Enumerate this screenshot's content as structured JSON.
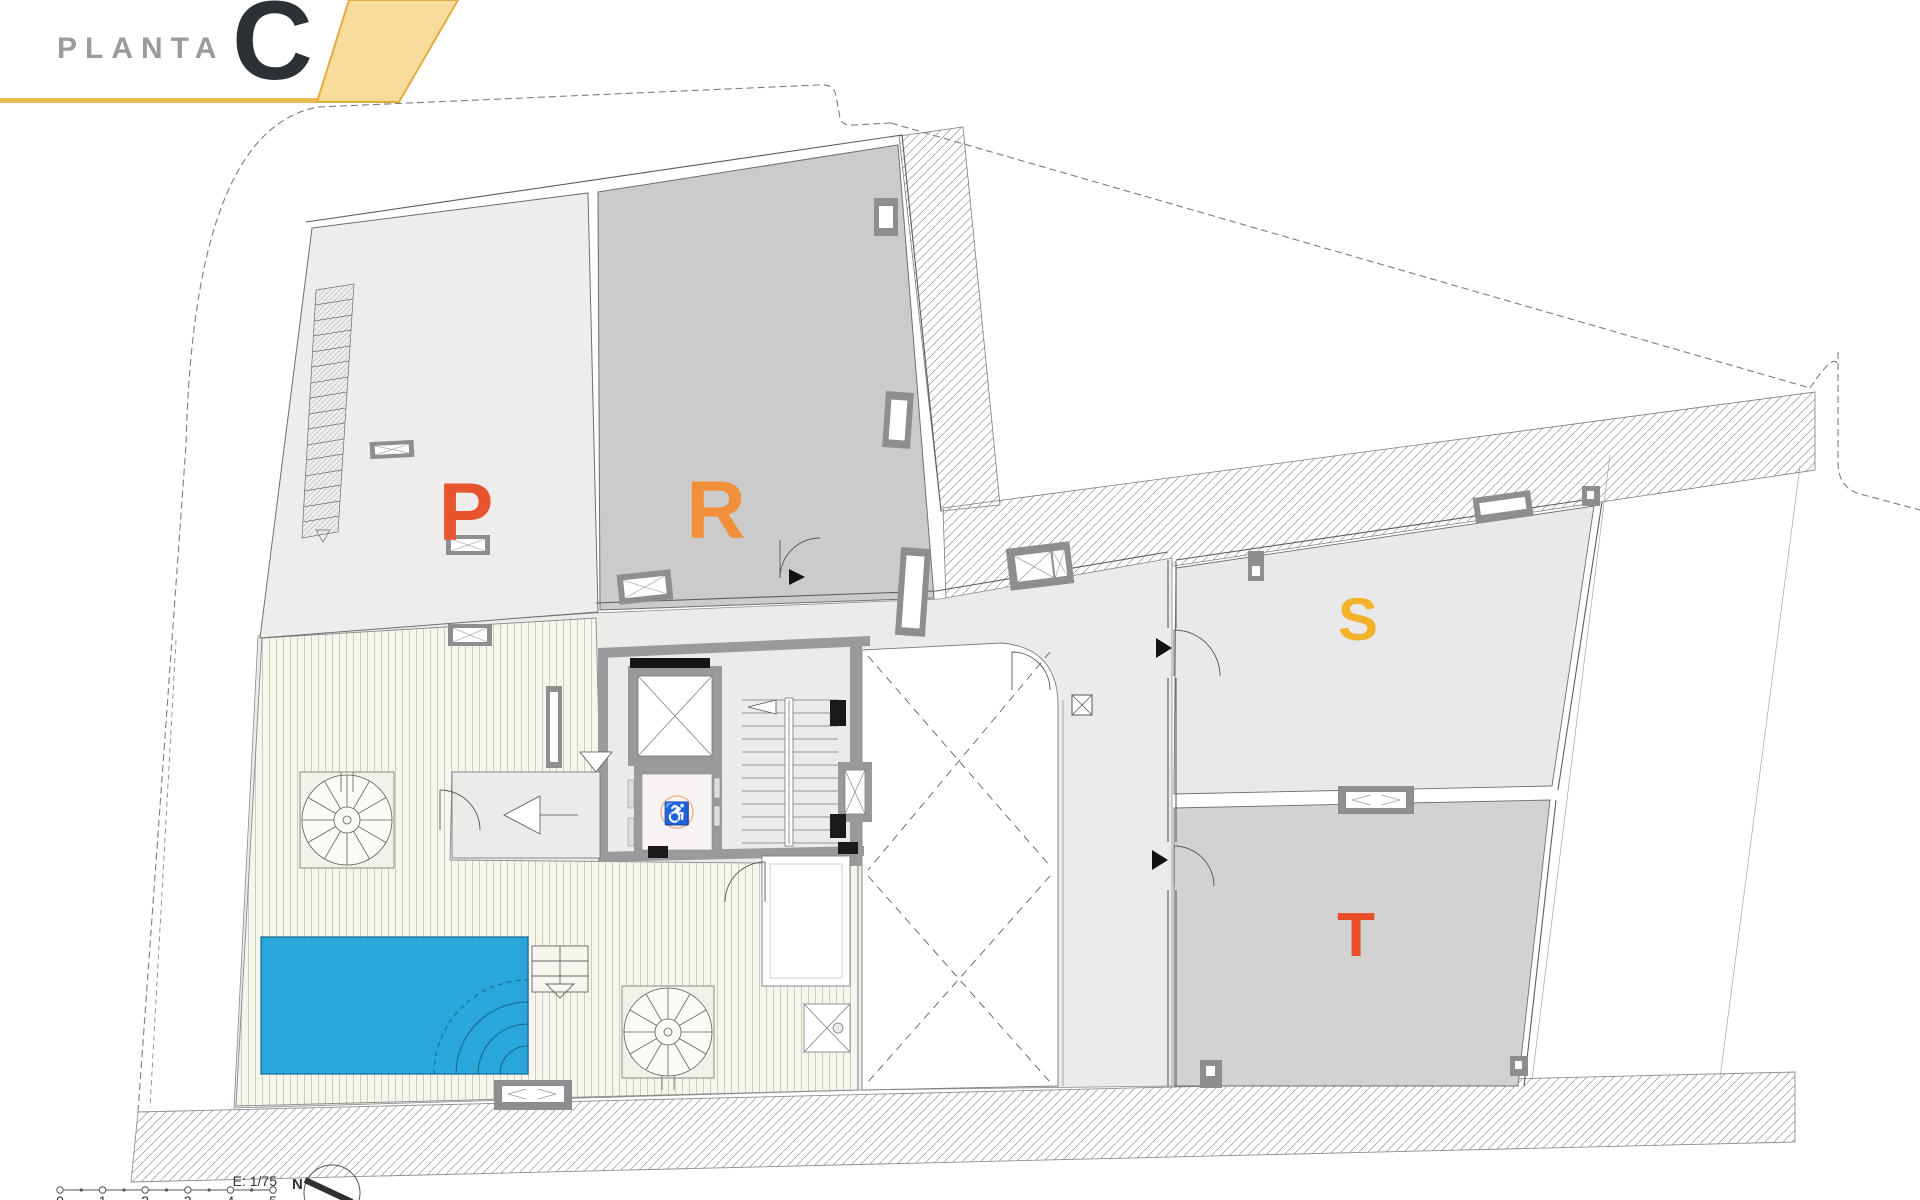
{
  "header": {
    "title": "PLANTA",
    "floor_letter": "C"
  },
  "rooms": [
    {
      "id": "P",
      "label": "P",
      "color": "#e8542e"
    },
    {
      "id": "R",
      "label": "R",
      "color": "#f28f3a"
    },
    {
      "id": "S",
      "label": "S",
      "color": "#f2b32b"
    },
    {
      "id": "T",
      "label": "T",
      "color": "#e84e28"
    }
  ],
  "scale": {
    "label": "E: 1/75",
    "ticks": [
      "0",
      "1",
      "2",
      "3",
      "4",
      "5"
    ]
  },
  "compass": {
    "label": "N"
  },
  "icons": {
    "wheelchair": "♿"
  },
  "colors": {
    "banner_fill": "#f8dc9c",
    "banner_edge": "#e2ac40",
    "accent_line": "#e8ba50",
    "title_gray": "#9b9b9b",
    "floor_letter_dark": "#2e3134",
    "pool_blue": "#29a7db",
    "room_p_fill": "#efecec",
    "room_r_fill": "#cbcbcb",
    "room_s_fill": "#e9e9ec",
    "room_t_fill": "#d2d2d2"
  }
}
